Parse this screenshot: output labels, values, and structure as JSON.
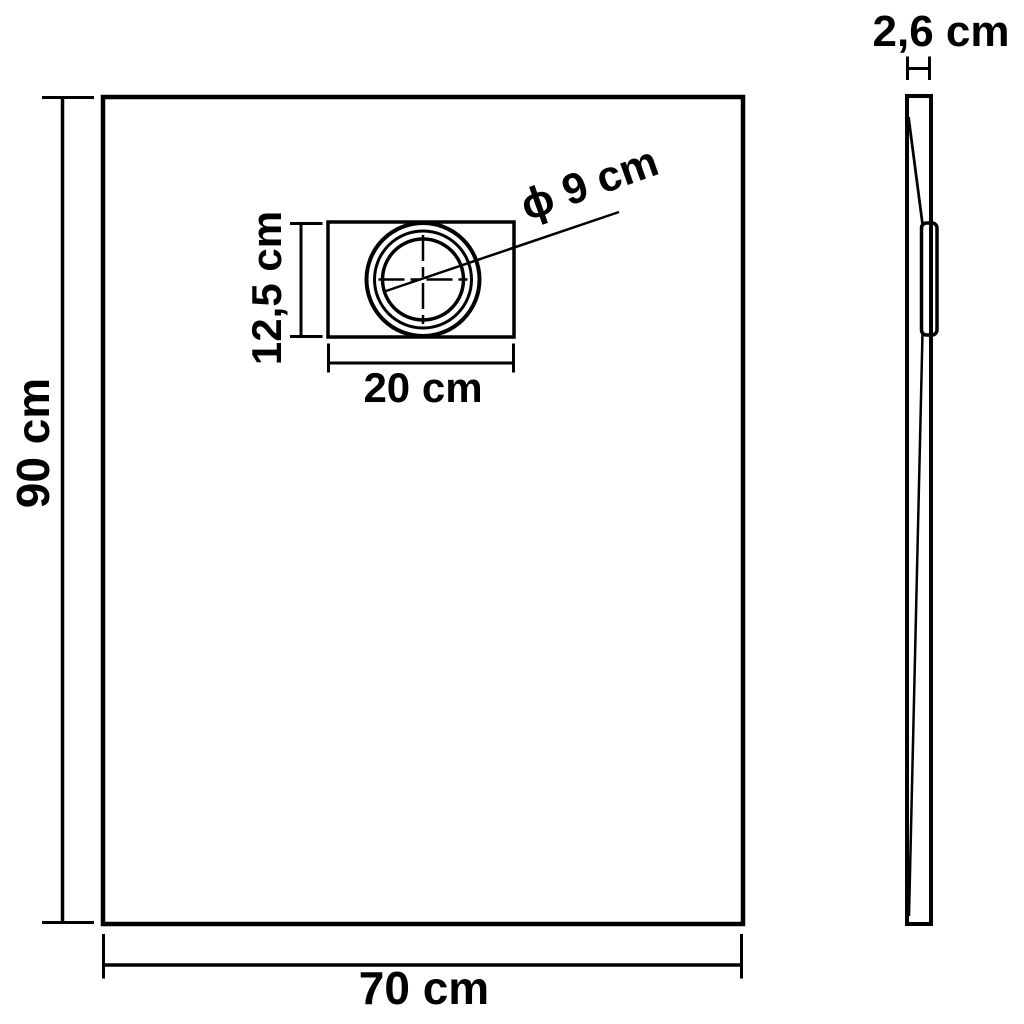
{
  "canvas": {
    "background": "#ffffff",
    "ink": "#000000"
  },
  "drawing": {
    "kind": "technical dimension drawing of a rectangular shower tray (top view and side profile)",
    "front_view": {
      "height_label": "90 cm",
      "width_label": "70 cm",
      "drain": {
        "box_height_label": "12,5 cm",
        "box_width_label": "20 cm",
        "diameter_label": "ϕ 9 cm"
      }
    },
    "side_view": {
      "thickness_label": "2,6 cm"
    }
  }
}
